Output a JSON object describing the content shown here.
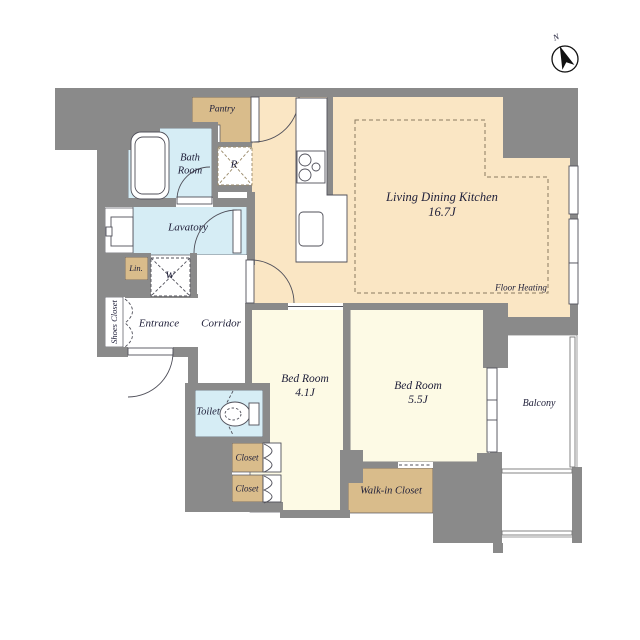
{
  "compass": {
    "label": "N"
  },
  "rooms": {
    "ldk": {
      "label": "Living Dining Kitchen",
      "size": "16.7J"
    },
    "floor_heating": {
      "label": "Floor Heating"
    },
    "bedroom_small": {
      "label": "Bed Room",
      "size": "4.1J"
    },
    "bedroom_large": {
      "label": "Bed Room",
      "size": "5.5J"
    },
    "balcony": {
      "label": "Balcony"
    },
    "walk_in_closet": {
      "label": "Walk-in Closet"
    },
    "toilet": {
      "label": "Toilet"
    },
    "closet_upper": {
      "label": "Closet"
    },
    "closet_lower": {
      "label": "Closet"
    },
    "entrance": {
      "label": "Entrance"
    },
    "corridor": {
      "label": "Corridor"
    },
    "shoes_closet": {
      "label": "Shoes Closet"
    },
    "lavatory": {
      "label": "Lavatory"
    },
    "bath_room": {
      "label": "Bath Room"
    },
    "pantry": {
      "label": "Pantry"
    },
    "linen": {
      "label": "Lin."
    },
    "washer": {
      "label": "W"
    },
    "refrigerator": {
      "label": "R"
    }
  },
  "colors": {
    "wall": "#8a8a8a",
    "ldk_fill": "#fae6c4",
    "bedroom_fill": "#fdfae5",
    "closet_fill": "#d9bc8b",
    "wet_area_fill": "#d6edf5",
    "balcony_fill": "#ffffff",
    "outline": "#50505a",
    "text": "#20203a"
  }
}
